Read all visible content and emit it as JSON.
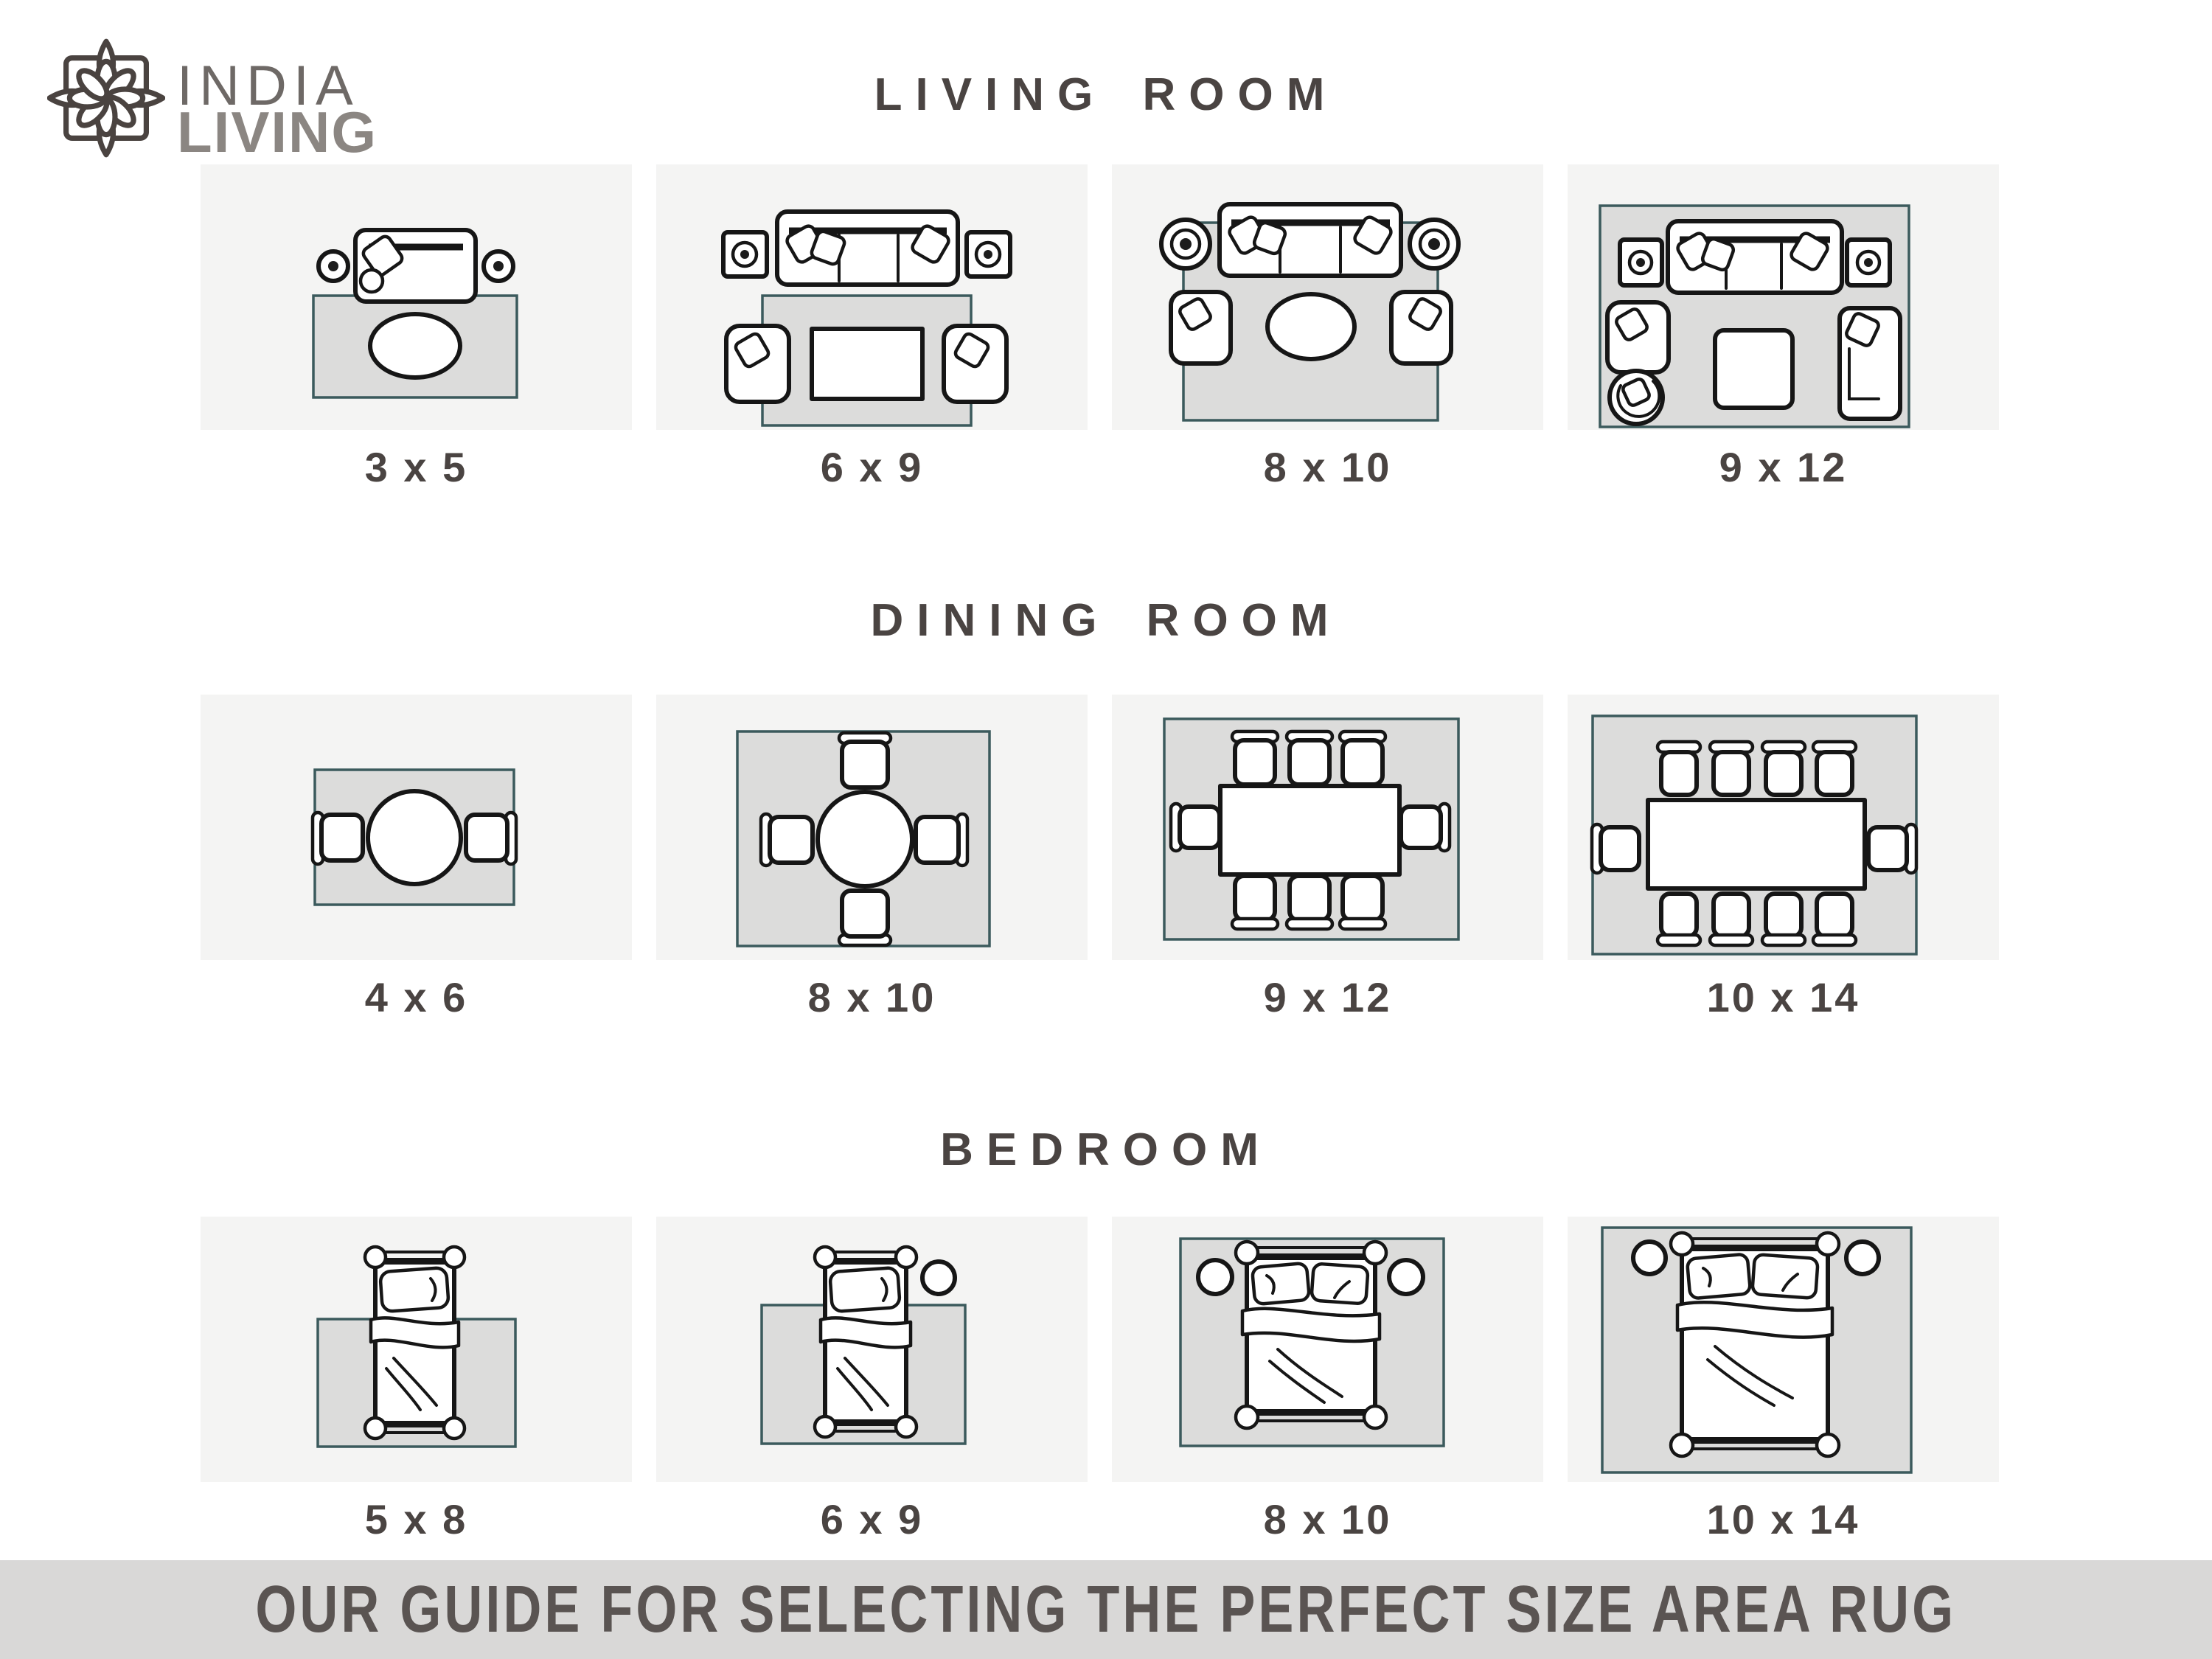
{
  "brand": {
    "name_line1": "INDIA",
    "name_line2": "LIVING"
  },
  "sections": [
    {
      "id": "living-room",
      "title": "LIVING ROOM",
      "items": [
        {
          "size": "3 x 5"
        },
        {
          "size": "6 x 9"
        },
        {
          "size": "8 x 10"
        },
        {
          "size": "9 x 12"
        }
      ]
    },
    {
      "id": "dining-room",
      "title": "DINING ROOM",
      "items": [
        {
          "size": "4 x 6"
        },
        {
          "size": "8 x 10"
        },
        {
          "size": "9 x 12"
        },
        {
          "size": "10 x 14"
        }
      ]
    },
    {
      "id": "bedroom",
      "title": "BEDROOM",
      "items": [
        {
          "size": "5 x 8"
        },
        {
          "size": "6 x 9"
        },
        {
          "size": "8 x 10"
        },
        {
          "size": "10 x 14"
        }
      ]
    }
  ],
  "footer": {
    "text": "OUR GUIDE FOR SELECTING THE PERFECT SIZE AREA RUG"
  },
  "colors": {
    "card_bg": "#f4f4f3",
    "rug_fill": "#dcdcdb",
    "rug_border": "#3b5a5c",
    "furniture_ink": "#161616",
    "heading_text": "#4a4442",
    "banner_bg": "#d9d8d7",
    "banner_text": "#5a5452",
    "logo_icon": "#4a4340",
    "logo_india": "#6e6966",
    "logo_living": "#8b8682"
  }
}
